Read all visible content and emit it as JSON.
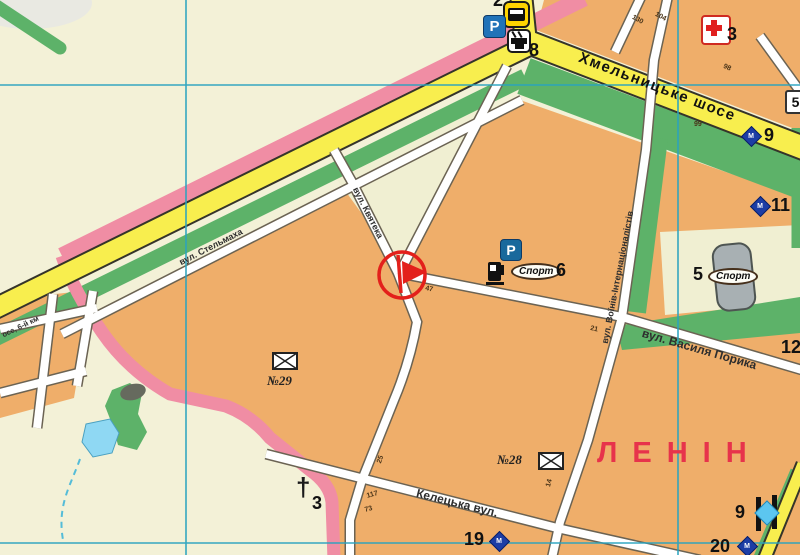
{
  "colors": {
    "base_cream": "#f3f1d7",
    "block_orange": "#efae6a",
    "pale_block": "#f0efd2",
    "road_yellow": "#f8ee4e",
    "road_casing": "#35342a",
    "street_casing": "#6b6353",
    "green_area": "#5db269",
    "boundary_pink": "#f08da4",
    "grid_teal": "#2aa3bf",
    "water_blue": "#8fd8f3",
    "marker_red": "#e3201b",
    "district_red": "#e7334b",
    "monument_navy": "#1d3da5",
    "sign_blue": "#2173b8",
    "bus_yellow": "#ffd400",
    "building_gray": "#a8b0b3",
    "memorial_blue": "#5cc6f0",
    "cross_red": "#e02020"
  },
  "labels": {
    "highway": "Хмельницьке шосе",
    "street_stelmakha": "вул. Стельмаха",
    "street_kvyateka": "вул. Квятека",
    "street_voiniv": "вул. Воїнів-Інтернаціоналістів",
    "street_poryka": "вул. Василя Порика",
    "street_keletska": "Келецька вул.",
    "street_shose_6km": "осе, 6-й км",
    "district_partial": "ЛЕНІН"
  },
  "poi": {
    "bus_stop_number": "2",
    "trolley_stop_number": "8",
    "parking": "P",
    "parking2": "P",
    "hospital_number": "3",
    "monument9_number": "9",
    "monument11_number": "11",
    "sport_label": "Спорт",
    "sport6_number": "6",
    "sport5_label": "Спорт",
    "sport5_number": "5",
    "badge5": "5",
    "poi12_number": "12",
    "post29": "№29",
    "post28": "№28",
    "church_cross": "†",
    "church_number": "3",
    "poi19_number": "19",
    "poi20_number": "20",
    "memorial9_number": "9",
    "monument_letter": "М"
  },
  "house_numbers": {
    "n130": "130",
    "n104": "104",
    "n98": "98",
    "n99": "99",
    "n47": "47",
    "n21": "21",
    "n117": "117",
    "n73": "73",
    "n25": "25",
    "n14": "14"
  }
}
